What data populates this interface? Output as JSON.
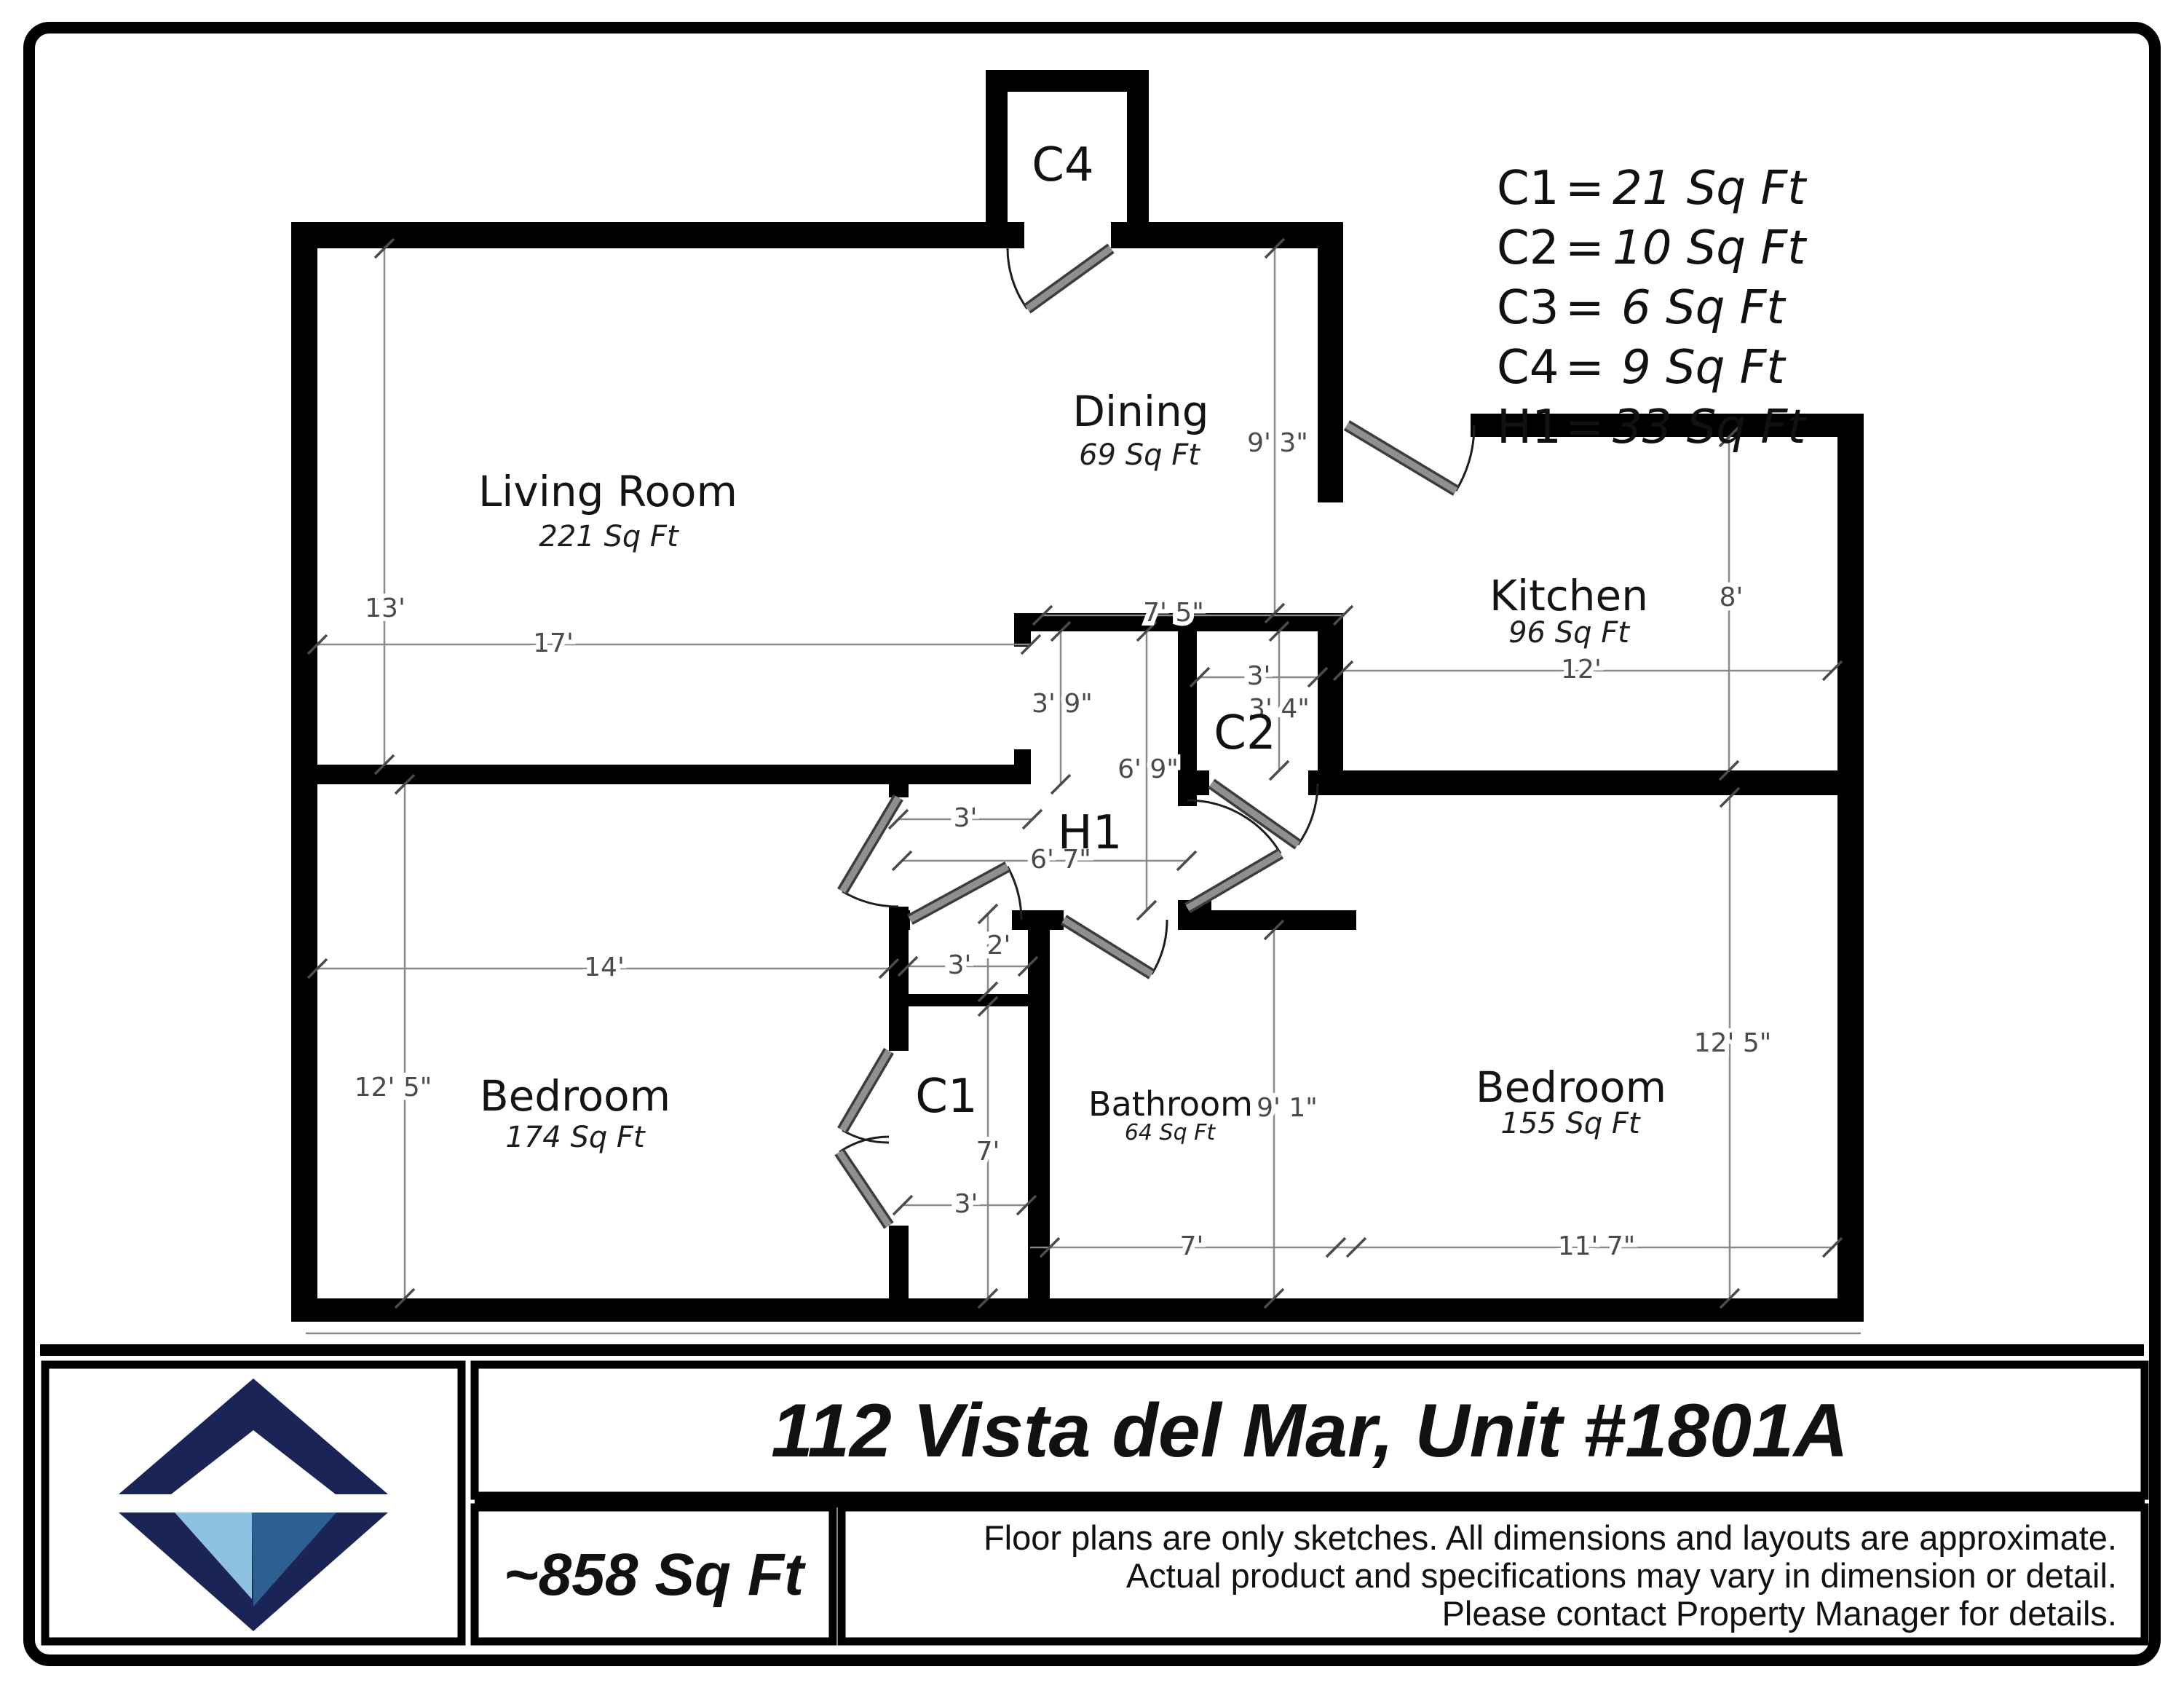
{
  "rooms": {
    "living": {
      "name": "Living Room",
      "area": "221 Sq Ft"
    },
    "dining": {
      "name": "Dining",
      "area": "69 Sq Ft"
    },
    "kitchen": {
      "name": "Kitchen",
      "area": "96 Sq Ft"
    },
    "bed_left": {
      "name": "Bedroom",
      "area": "174 Sq Ft"
    },
    "bathroom": {
      "name": "Bathroom",
      "area": "64  Sq Ft"
    },
    "bed_right": {
      "name": "Bedroom",
      "area": "155 Sq Ft"
    }
  },
  "spaces": {
    "c4": "C4",
    "c2": "C2",
    "c1": "C1",
    "h1": "H1"
  },
  "legend": {
    "separator": "=",
    "items": [
      {
        "code": "C1",
        "value": "21 Sq Ft"
      },
      {
        "code": "C2",
        "value": "10 Sq Ft"
      },
      {
        "code": "C3",
        "value": "6 Sq Ft"
      },
      {
        "code": "C4",
        "value": "9 Sq Ft"
      },
      {
        "code": "H1",
        "value": "33 Sq Ft"
      }
    ]
  },
  "dims": {
    "living_h": "13'",
    "living_w": "17'",
    "dining_h": "9' 3\"",
    "dining_w": "7' 5\"",
    "kitchen_h": "8'",
    "kitchen_w": "12'",
    "c2_w": "3'",
    "c2_h": "3' 4\"",
    "h1_upper": "3' 9\"",
    "h1_h": "6' 9\"",
    "h1_w": "6' 7\"",
    "h1_pass": "3'",
    "c3_w": "3'",
    "c3_h": "2'",
    "c1_h": "7'",
    "c1_bottom": "3'",
    "bath_w": "7'",
    "bath_h": "9' 1\"",
    "bed_left_w": "14'",
    "bed_left_h": "12' 5\"",
    "bed_right_w": "11' 7\"",
    "bed_right_h": "12' 5\""
  },
  "footer": {
    "address": "112 Vista del Mar, Unit #1801A",
    "total_area": "~858 Sq Ft",
    "disclaimer": [
      "Floor plans are only sketches. All dimensions and layouts are approximate.",
      "Actual product and specifications may vary in dimension or detail.",
      "Please contact Property Manager for details."
    ]
  },
  "colors": {
    "wall": "#000000",
    "dimension": "#4b4b4b",
    "door": "#8f8f8f",
    "logo_navy": "#1b2456",
    "logo_light_blue": "#8dc1e0",
    "logo_steel_blue": "#2c6093"
  }
}
